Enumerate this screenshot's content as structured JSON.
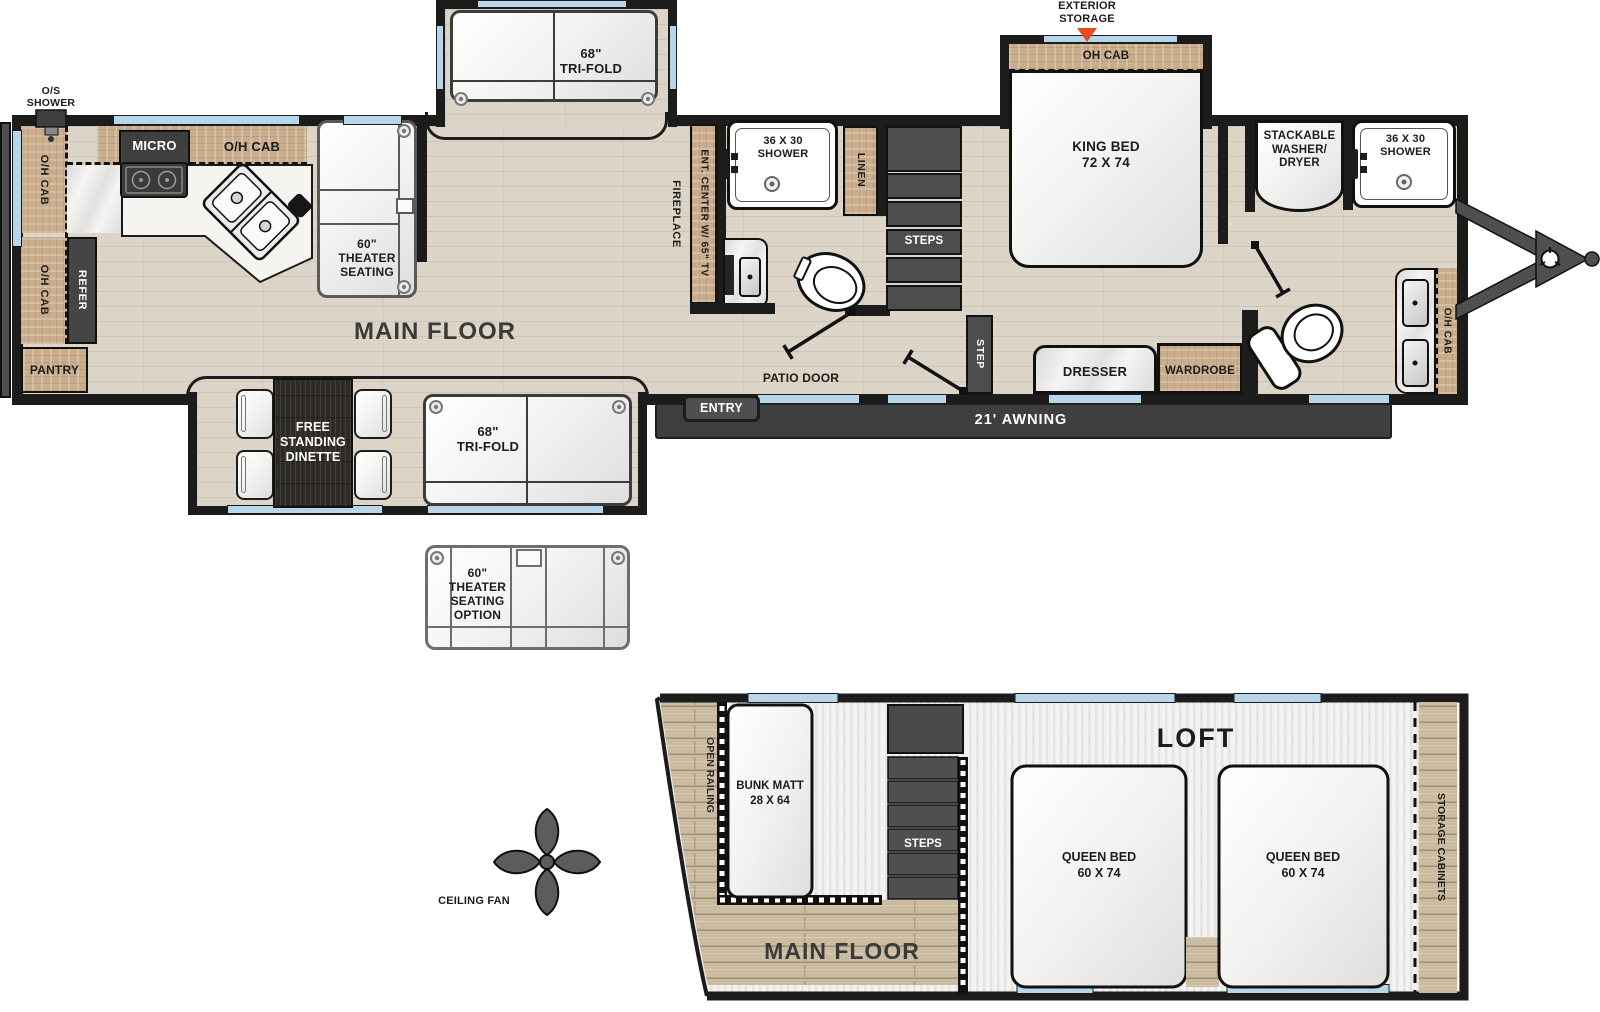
{
  "colors": {
    "wall": "#1c1c1c",
    "wood_floor": "#dcd5c7",
    "cabinet_wood": "#c9ad8c",
    "dark_fixture": "#454545",
    "window_blue": "#b7d6ea",
    "arrow_orange": "#e84b1f",
    "awning_gray": "#3f3f3f"
  },
  "main": {
    "os_shower": "O/S\nSHOWER",
    "exterior_storage": "EXTERIOR\nSTORAGE",
    "oh_cab": "O/H CAB",
    "oh_cab_bed": "OH CAB",
    "micro": "MICRO",
    "refer": "REFER",
    "pantry": "PANTRY",
    "theater_60": "60\"\nTHEATER\nSEATING",
    "tri_fold_68": "68\"\nTRI-FOLD",
    "main_floor": "MAIN FLOOR",
    "fireplace": "FIREPLACE",
    "ent_center": "ENT. CENTER W/ 65\" TV",
    "shower_36x30": "36 X 30\nSHOWER",
    "linen": "LINEN",
    "steps": "STEPS",
    "step": "STEP",
    "patio_door": "PATIO DOOR",
    "entry": "ENTRY",
    "awning_21": "21' AWNING",
    "king_bed": "KING BED\n72 X 74",
    "washer": "STACKABLE\nWASHER/\nDRYER",
    "dresser": "DRESSER",
    "wardrobe": "WARDROBE",
    "dinette": "FREE\nSTANDING\nDINETTE",
    "theater_option": "60\"\nTHEATER\nSEATING\nOPTION",
    "ceiling_fan": "CEILING FAN"
  },
  "loft": {
    "title": "LOFT",
    "open_railing": "OPEN RAILING",
    "bunk_l1": "BUNK MATT",
    "bunk_l2": "28 X 64",
    "steps": "STEPS",
    "queen_l1": "QUEEN BED",
    "queen_l2": "60 X 74",
    "storage_cabinets": "STORAGE CABINETS",
    "main_floor": "MAIN FLOOR"
  }
}
